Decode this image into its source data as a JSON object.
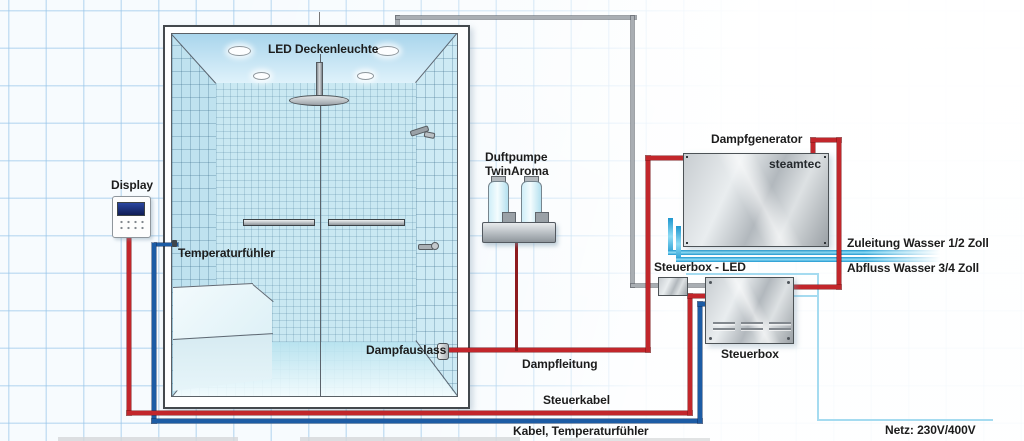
{
  "labels": {
    "led_ceiling": "LED Deckenleuchte",
    "display": "Display",
    "temperature_sensor": "Temperaturfühler",
    "aroma_pump_line1": "Duftpumpe",
    "aroma_pump_line2": "TwinAroma",
    "steam_generator": "Dampfgenerator",
    "brand": "steamtec",
    "control_box_led": "Steuerbox - LED",
    "control_box": "Steuerbox",
    "water_supply": "Zuleitung Wasser 1/2 Zoll",
    "water_drain": "Abfluss Wasser 3/4 Zoll",
    "steam_outlet": "Dampfauslass",
    "steam_pipe": "Dampfleitung",
    "control_cable": "Steuerkabel",
    "temp_cable": "Kabel, Temperaturfühler",
    "mains": "Netz: 230V/400V"
  },
  "colors": {
    "steam_pipe_red": "#c2262b",
    "cable_blue": "#1c5ca5",
    "water_cyan": "#2ea8de",
    "mains_cyan": "#a5dbf0",
    "cable_gray": "#a9aeb3"
  }
}
